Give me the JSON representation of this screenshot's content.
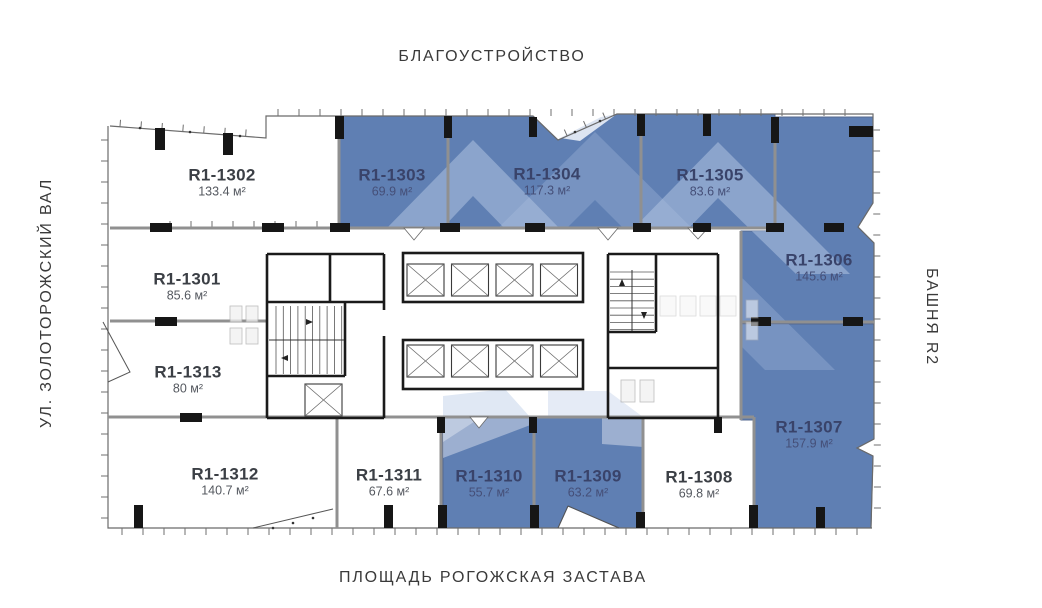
{
  "labels": {
    "top": "БЛАГОУСТРОЙСТВО",
    "bottom": "ПЛОЩАДЬ РОГОЖСКАЯ ЗАСТАВА",
    "left": "УЛ. ЗОЛОТОРОЖСКИЙ ВАЛ",
    "right": "БАШНЯ R2"
  },
  "legend_colors": {
    "available_fill": "#5f7fb3",
    "watermark_tint": "#aec3e0",
    "wall_gray": "#909090",
    "wall_black": "#1a1a1a"
  },
  "units": [
    {
      "id": "R1-1301",
      "area": "85.6 м²",
      "status": "default"
    },
    {
      "id": "R1-1302",
      "area": "133.4 м²",
      "status": "default"
    },
    {
      "id": "R1-1303",
      "area": "69.9 м²",
      "status": "available"
    },
    {
      "id": "R1-1304",
      "area": "117.3 м²",
      "status": "available"
    },
    {
      "id": "R1-1305",
      "area": "83.6 м²",
      "status": "available"
    },
    {
      "id": "R1-1306",
      "area": "145.6 м²",
      "status": "available"
    },
    {
      "id": "R1-1307",
      "area": "157.9 м²",
      "status": "available"
    },
    {
      "id": "R1-1308",
      "area": "69.8 м²",
      "status": "default"
    },
    {
      "id": "R1-1309",
      "area": "63.2 м²",
      "status": "available"
    },
    {
      "id": "R1-1310",
      "area": "55.7 м²",
      "status": "available"
    },
    {
      "id": "R1-1311",
      "area": "67.6 м²",
      "status": "default"
    },
    {
      "id": "R1-1312",
      "area": "140.7 м²",
      "status": "default"
    },
    {
      "id": "R1-1313",
      "area": "80 м²",
      "status": "default"
    }
  ]
}
